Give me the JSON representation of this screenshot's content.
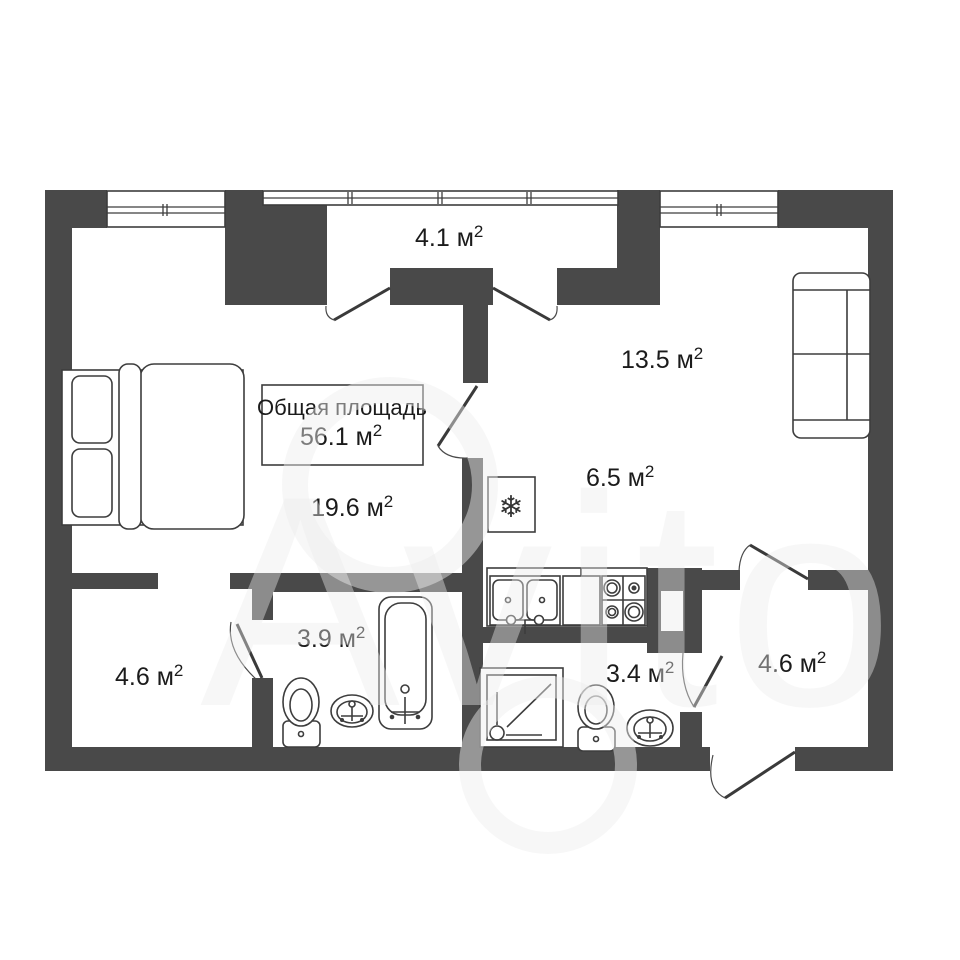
{
  "title": "Floor plan",
  "watermark": {
    "text": "Avito"
  },
  "total_box": {
    "line1": "Общая площадь",
    "area_value": "56.1 м",
    "sup": "2"
  },
  "rooms": [
    {
      "id": "balcony",
      "area_value": "4.1 м",
      "sup": "2"
    },
    {
      "id": "living-room",
      "area_value": "13.5 м",
      "sup": "2"
    },
    {
      "id": "kitchen",
      "area_value": "6.5 м",
      "sup": "2"
    },
    {
      "id": "bedroom",
      "area_value": "19.6 м",
      "sup": "2"
    },
    {
      "id": "closet",
      "area_value": "4.6 м",
      "sup": "2"
    },
    {
      "id": "bathroom",
      "area_value": "3.9 м",
      "sup": "2"
    },
    {
      "id": "shower-room",
      "area_value": "3.4 м",
      "sup": "2"
    },
    {
      "id": "hallway",
      "area_value": "4.6 м",
      "sup": "2"
    }
  ],
  "icons": {
    "fridge_snowflake": "❄"
  },
  "colors": {
    "wall": "#494949",
    "line": "#3d3d3d",
    "text": "#1b1b1b",
    "background": "#ffffff"
  }
}
